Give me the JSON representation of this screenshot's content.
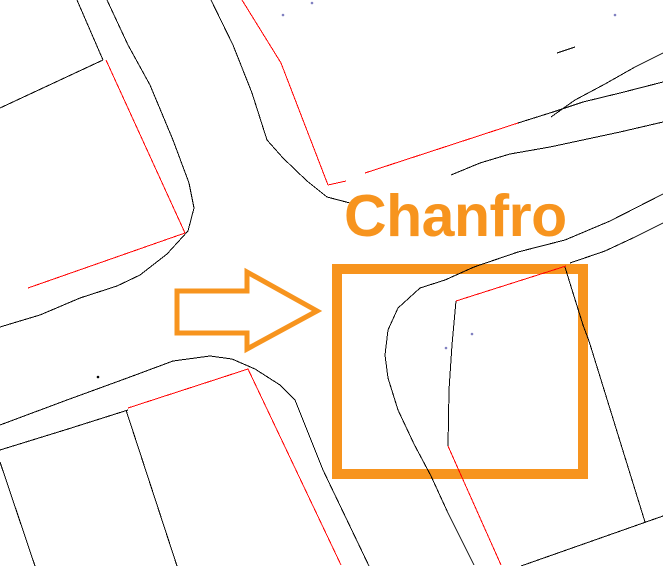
{
  "canvas": {
    "width": 663,
    "height": 566,
    "background": "#ffffff"
  },
  "colors": {
    "plan_line_black": "#000000",
    "plan_line_red": "#ff0000",
    "annotation_orange": "#f7941e",
    "shape_orange": "#f7941e",
    "point_marker_blue": "#8080c0",
    "point_marker_black": "#000000"
  },
  "annotation": {
    "label": "Chanfro",
    "x": 344,
    "y": 187,
    "font_size_px": 59,
    "color": "#f7941e"
  },
  "highlight_rect": {
    "x": 337,
    "y": 269,
    "width": 246,
    "height": 205,
    "stroke": "#f7941e",
    "stroke_width": 10
  },
  "arrow": {
    "points": [
      [
        177,
        291
      ],
      [
        247,
        291
      ],
      [
        247,
        272
      ],
      [
        317,
        311
      ],
      [
        247,
        349
      ],
      [
        247,
        333
      ],
      [
        177,
        333
      ]
    ],
    "stroke": "#f7941e",
    "stroke_width": 5,
    "fill": "#ffffff"
  },
  "plan_lines": {
    "black": [
      [
        [
          77,
          0
        ],
        [
          103,
          60
        ]
      ],
      [
        [
          0,
          108
        ],
        [
          103,
          60
        ]
      ],
      [
        [
          107,
          0
        ],
        [
          128,
          45
        ],
        [
          150,
          85
        ],
        [
          173,
          140
        ],
        [
          189,
          183
        ],
        [
          194,
          208
        ],
        [
          188,
          231
        ],
        [
          167,
          254
        ],
        [
          140,
          275
        ],
        [
          117,
          286
        ],
        [
          80,
          298
        ],
        [
          40,
          315
        ],
        [
          0,
          327
        ]
      ],
      [
        [
          211,
          0
        ],
        [
          233,
          45
        ],
        [
          252,
          93
        ],
        [
          267,
          140
        ],
        [
          283,
          158
        ],
        [
          307,
          181
        ],
        [
          327,
          197
        ],
        [
          350,
          203
        ]
      ],
      [
        [
          551,
          117
        ],
        [
          575,
          100
        ],
        [
          605,
          84
        ],
        [
          635,
          67
        ],
        [
          663,
          53
        ]
      ],
      [
        [
          518,
          123
        ],
        [
          553,
          112
        ],
        [
          583,
          102
        ],
        [
          620,
          93
        ],
        [
          663,
          82
        ]
      ],
      [
        [
          451,
          175
        ],
        [
          480,
          163
        ],
        [
          510,
          154
        ],
        [
          550,
          147
        ],
        [
          620,
          132
        ],
        [
          663,
          122
        ]
      ],
      [
        [
          663,
          194
        ],
        [
          610,
          221
        ],
        [
          565,
          240
        ],
        [
          518,
          252
        ],
        [
          474,
          267
        ],
        [
          445,
          280
        ],
        [
          420,
          288
        ],
        [
          398,
          308
        ],
        [
          388,
          330
        ],
        [
          385,
          355
        ],
        [
          388,
          378
        ],
        [
          398,
          410
        ],
        [
          414,
          444
        ],
        [
          431,
          476
        ],
        [
          448,
          513
        ],
        [
          474,
          565
        ]
      ],
      [
        [
          570,
          263
        ],
        [
          605,
          251
        ],
        [
          635,
          237
        ],
        [
          663,
          223
        ]
      ],
      [
        [
          565,
          267
        ],
        [
          573,
          293
        ],
        [
          583,
          325
        ],
        [
          589,
          341
        ],
        [
          645,
          522
        ]
      ],
      [
        [
          521,
          566
        ],
        [
          663,
          516
        ]
      ],
      [
        [
          0,
          425
        ],
        [
          67,
          400
        ],
        [
          130,
          377
        ],
        [
          173,
          361
        ],
        [
          210,
          356
        ],
        [
          232,
          359
        ],
        [
          255,
          369
        ],
        [
          280,
          385
        ],
        [
          295,
          400
        ],
        [
          323,
          470
        ],
        [
          369,
          566
        ]
      ],
      [
        [
          0,
          450
        ],
        [
          68,
          429
        ],
        [
          128,
          410
        ]
      ],
      [
        [
          0,
          462
        ],
        [
          35,
          566
        ]
      ],
      [
        [
          126,
          410
        ],
        [
          177,
          566
        ]
      ],
      [
        [
          456,
          301
        ],
        [
          452,
          345
        ],
        [
          449,
          390
        ],
        [
          448,
          446
        ]
      ],
      [
        [
          557,
          53
        ],
        [
          575,
          47
        ]
      ]
    ],
    "red": [
      [
        [
          106,
          60
        ],
        [
          185,
          233
        ]
      ],
      [
        [
          185,
          233
        ],
        [
          28,
          288
        ]
      ],
      [
        [
          242,
          0
        ],
        [
          281,
          63
        ],
        [
          328,
          185
        ]
      ],
      [
        [
          328,
          185
        ],
        [
          346,
          181
        ]
      ],
      [
        [
          365,
          173
        ],
        [
          518,
          123
        ]
      ],
      [
        [
          456,
          301
        ],
        [
          566,
          266
        ]
      ],
      [
        [
          448,
          446
        ],
        [
          501,
          565
        ]
      ],
      [
        [
          128,
          408
        ],
        [
          248,
          369
        ],
        [
          341,
          565
        ]
      ]
    ]
  },
  "point_markers": [
    {
      "x": 283,
      "y": 15,
      "color": "#8080c0"
    },
    {
      "x": 312,
      "y": 3,
      "color": "#8080c0"
    },
    {
      "x": 615,
      "y": 15,
      "color": "#8080c0"
    },
    {
      "x": 446,
      "y": 348,
      "color": "#8080c0"
    },
    {
      "x": 472,
      "y": 334,
      "color": "#8080c0"
    },
    {
      "x": 98,
      "y": 377,
      "color": "#000000"
    }
  ]
}
